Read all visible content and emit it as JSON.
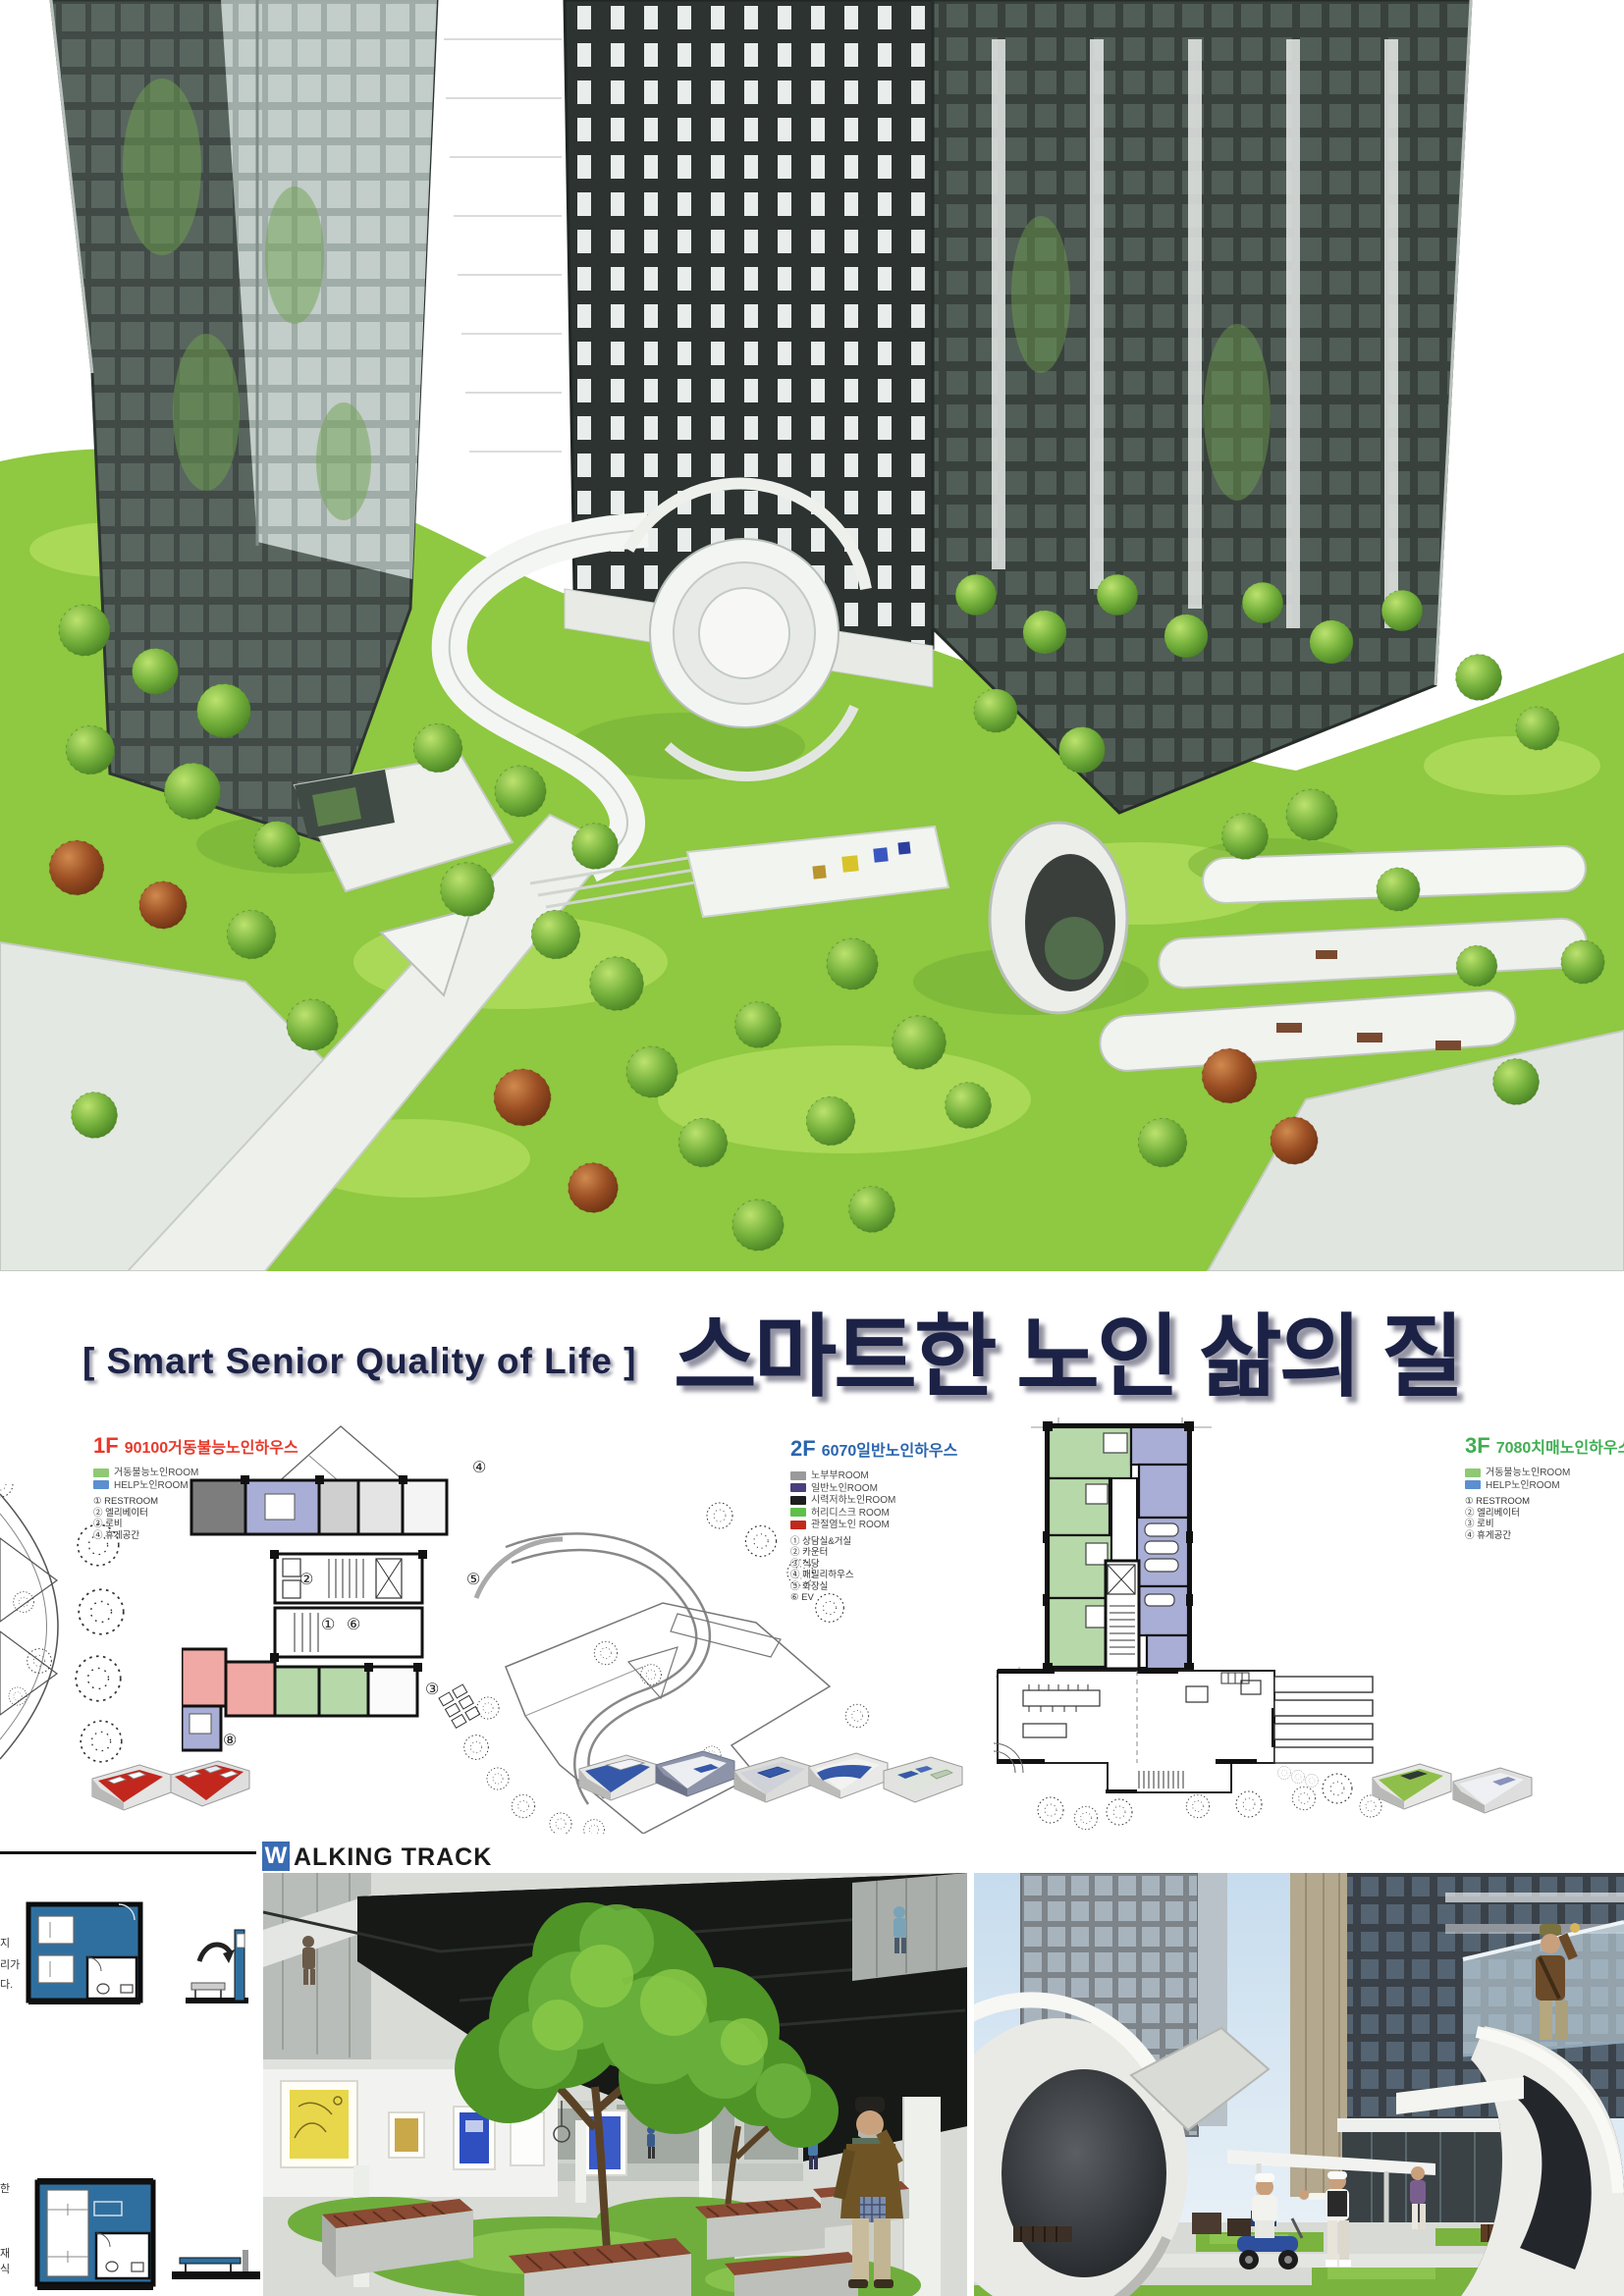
{
  "poster": {
    "title_en": "[ Smart Senior Quality of Life ]",
    "title_ko": "스마트한 노인 삶의 질",
    "accent_navy": "#1c2246"
  },
  "plans": [
    {
      "floor": "1F",
      "name": "90100거동불능노인하우스",
      "label_color": "#e8392b",
      "room_legend": [
        {
          "label": "거동불능노인ROOM",
          "color": "#8fc973"
        },
        {
          "label": "HELP노인ROOM",
          "color": "#5b8fd0"
        }
      ],
      "key_legend": [
        "① RESTROOM",
        "② 엘리베이터",
        "③ 로비",
        "④ 휴게공간"
      ],
      "plan_numbers": [
        "①",
        "②",
        "③",
        "④",
        "⑤",
        "⑥",
        "⑧"
      ]
    },
    {
      "floor": "2F",
      "name": "6070일반노인하우스",
      "label_color": "#2a65ae",
      "room_legend": [
        {
          "label": "노부부ROOM",
          "color": "#9a9a9a"
        },
        {
          "label": "일반노인ROOM",
          "color": "#4a3f7d"
        },
        {
          "label": "시력저하노인ROOM",
          "color": "#1e1e1e"
        },
        {
          "label": "허리디스크 ROOM",
          "color": "#5fbf4a"
        },
        {
          "label": "관절염노인 ROOM",
          "color": "#c02a1e"
        }
      ],
      "key_legend": [
        "① 상담실&거실",
        "② 카운터",
        "③ 식당",
        "④ 패밀리하우스",
        "⑤ 화장실",
        "⑥ EV"
      ]
    },
    {
      "floor": "3F",
      "name": "7080치매노인하우스",
      "label_color": "#3fae52",
      "room_legend": [
        {
          "label": "거동불능노인ROOM",
          "color": "#8fc973"
        },
        {
          "label": "HELP노인ROOM",
          "color": "#5b8fd0"
        }
      ],
      "key_legend": [
        "① RESTROOM",
        "② 엘리베이터",
        "③ 로비",
        "④ 휴게공간"
      ]
    }
  ],
  "walking_track": {
    "initial": "W",
    "rest": "ALKING TRACK",
    "highlight_color": "#3a6cb3"
  },
  "margin_fragments": {
    "upper": [
      "지",
      "리가",
      "다."
    ],
    "lower": [
      "한",
      "재",
      "식"
    ]
  }
}
